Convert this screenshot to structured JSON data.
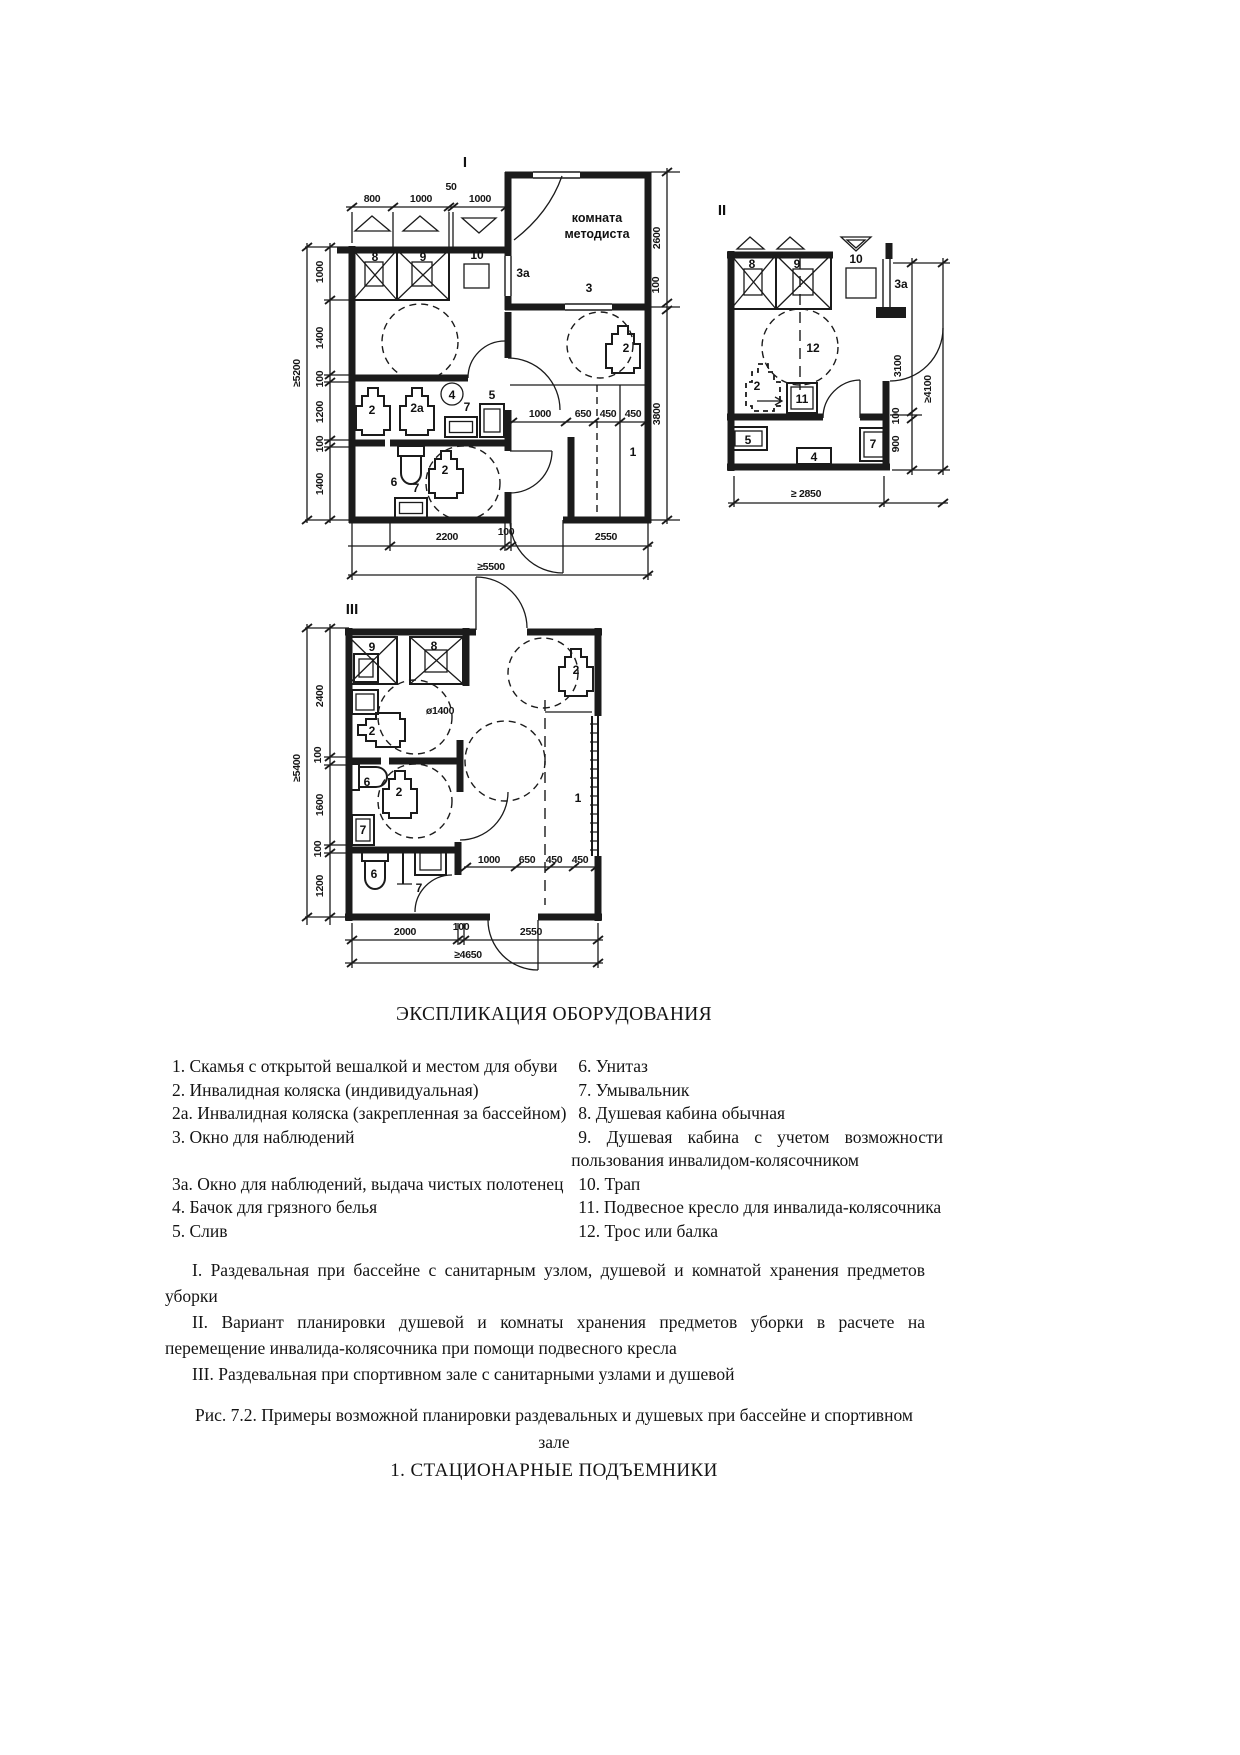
{
  "plans": {
    "p1": {
      "name": "I",
      "room": {
        "line1": "комната",
        "line2": "методиста"
      },
      "top_dims": [
        "800",
        "1000",
        "50",
        "1000"
      ],
      "left_total": "≥5200",
      "left_dims": [
        "1000",
        "1400",
        "100",
        "1200",
        "100",
        "1400"
      ],
      "right_dims": [
        "2600",
        "100",
        "3800"
      ],
      "inner_dims": [
        "1000",
        "650",
        "450",
        "450"
      ],
      "bottom_dims": [
        "2200",
        "100",
        "2550"
      ],
      "bottom_total": "≥5500",
      "eq": {
        "shower_std": "8",
        "shower_acc": "9",
        "drain_grate": "10",
        "window_towels": "3а",
        "window": "3",
        "wheelchair_row": "2",
        "wheelchair_pool": "2а",
        "laundry_tank": "4",
        "washbasin_row": "7",
        "drain": "5",
        "wheelchair_mid": "2",
        "toilet": "6",
        "wheelchair_wc": "2",
        "washbasin_wc": "7",
        "bench": "1"
      }
    },
    "p2": {
      "name": "II",
      "right_dims": [
        "3100",
        "100",
        "900"
      ],
      "right_total": "≥4100",
      "bottom_total": "≥ 2850",
      "eq": {
        "shower_std": "8",
        "shower_acc": "9",
        "drain_grate": "10",
        "window_towels": "3а",
        "rope": "12",
        "wheelchair": "2",
        "seat": "11",
        "drain": "5",
        "laundry_tank": "4",
        "washbasin": "7"
      }
    },
    "p3": {
      "name": "III",
      "left_total": "≥5400",
      "left_dims": [
        "2400",
        "100",
        "1600",
        "100",
        "1200"
      ],
      "inner_dims": [
        "1000",
        "650",
        "450",
        "450"
      ],
      "bottom_dims": [
        "2000",
        "100",
        "2550"
      ],
      "bottom_total": "≥4650",
      "eq": {
        "shower_acc": "9",
        "shower_std": "8",
        "turning_circle": "ø1400",
        "wheelchair_top": "2",
        "wheelchair_left": "2",
        "toilet_mid": "6",
        "wheelchair_mid": "2",
        "washbasin_mid": "7",
        "toilet_bot": "6",
        "washbasin_bot": "7",
        "bench": "1"
      }
    }
  },
  "explication": {
    "title": "ЭКСПЛИКАЦИЯ ОБОРУДОВАНИЯ",
    "left": [
      "1. Скамья с открытой вешалкой и местом для обуви",
      "2. Инвалидная коляска (индивидуальная)",
      "2а. Инвалидная коляска (закрепленная за бассейном)",
      "3. Окно для наблюдений",
      "3а. Окно для наблюдений, выдача чистых полотенец",
      "4. Бачок для грязного белья",
      "5. Слив"
    ],
    "right": [
      "6. Унитаз",
      "7. Умывальник",
      "8. Душевая кабина обычная",
      "9. Душевая кабина с учетом возможности пользования инвалидом-колясочником",
      "10. Трап",
      "11. Подвесное кресло для инвалида-колясочника",
      "12. Трос или балка"
    ],
    "notes": [
      "I. Раздевальная при бассейне с санитарным узлом, душевой и комнатой хранения предметов уборки",
      "II. Вариант планировки душевой и комнаты хранения предметов уборки в расчете на перемещение инвалида-колясочника при помощи подвесного кресла",
      "III. Раздевальная при спортивном зале с санитарными узлами и душевой"
    ],
    "caption": "Рис. 7.2. Примеры возможной планировки раздевальных и душевых при бассейне и спортивном зале",
    "heading": "1. СТАЦИОНАРНЫЕ ПОДЪЕМНИКИ"
  }
}
